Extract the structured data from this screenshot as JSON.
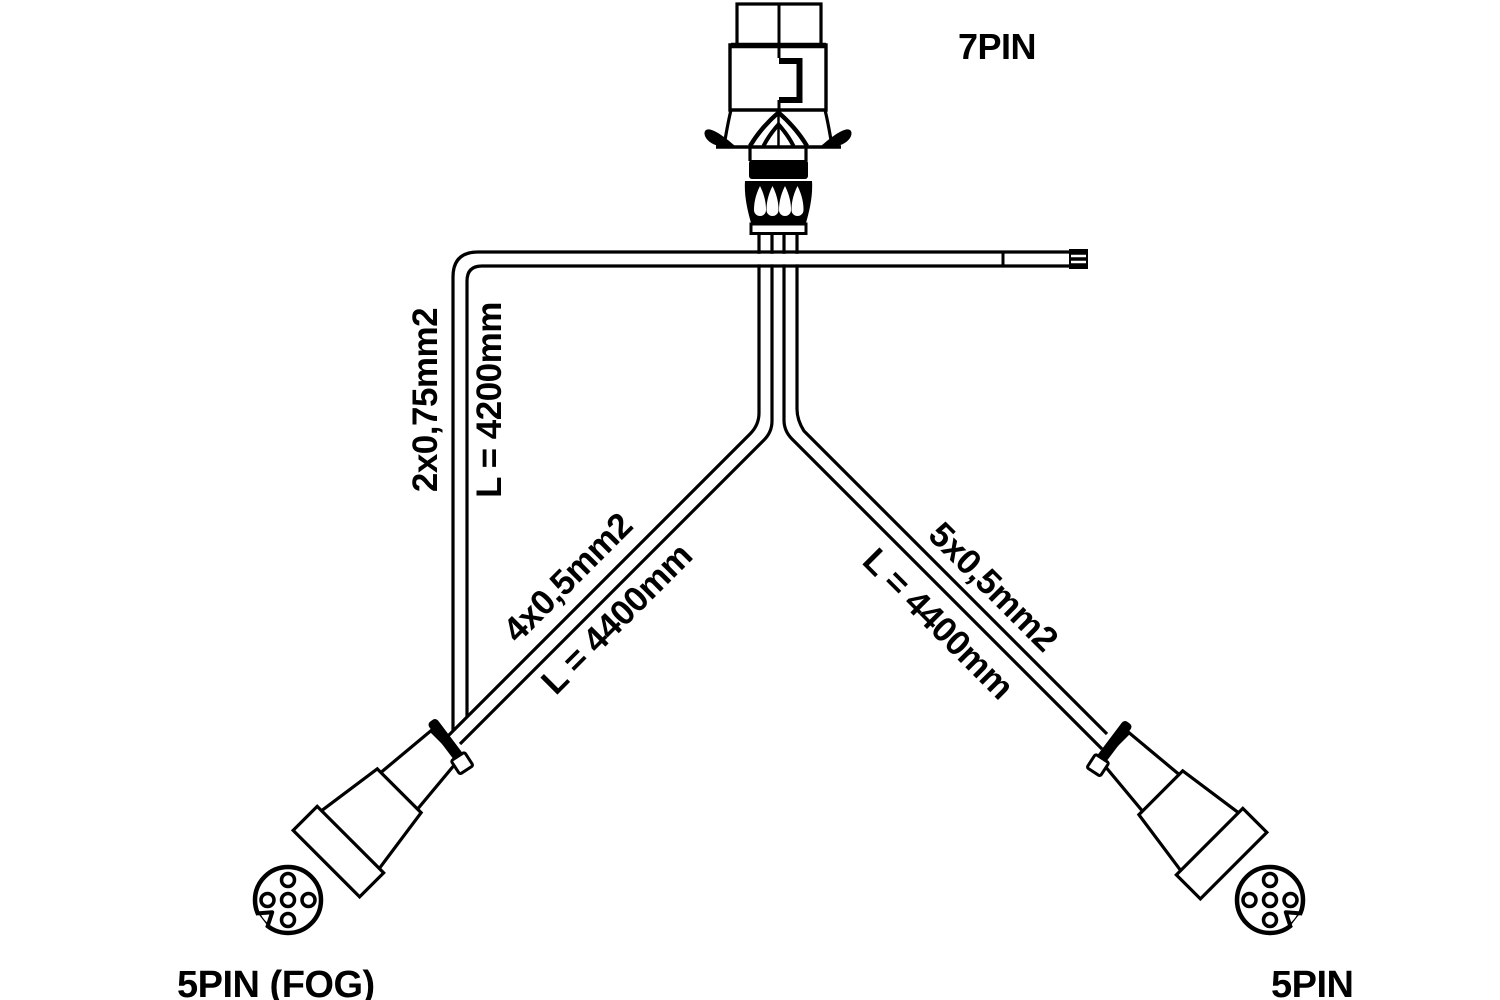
{
  "diagram": {
    "title": "trailer wiring harness drawing",
    "connector_top": {
      "label": "7PIN",
      "pins": 7
    },
    "connector_bottom_left": {
      "label": "5PIN (FOG)",
      "pins": 5
    },
    "connector_bottom_right": {
      "label": "5PIN",
      "pins": 5
    },
    "cables": {
      "fog_extension": {
        "spec": "2x0,75mm2",
        "length": "L = 4200mm"
      },
      "left_branch": {
        "spec": "4x0,5mm2",
        "length": "L = 4400mm"
      },
      "right_branch": {
        "spec": "5x0,5mm2",
        "length": "L = 4400mm"
      }
    },
    "colors": {
      "line": "#000000",
      "background": "#ffffff"
    }
  }
}
